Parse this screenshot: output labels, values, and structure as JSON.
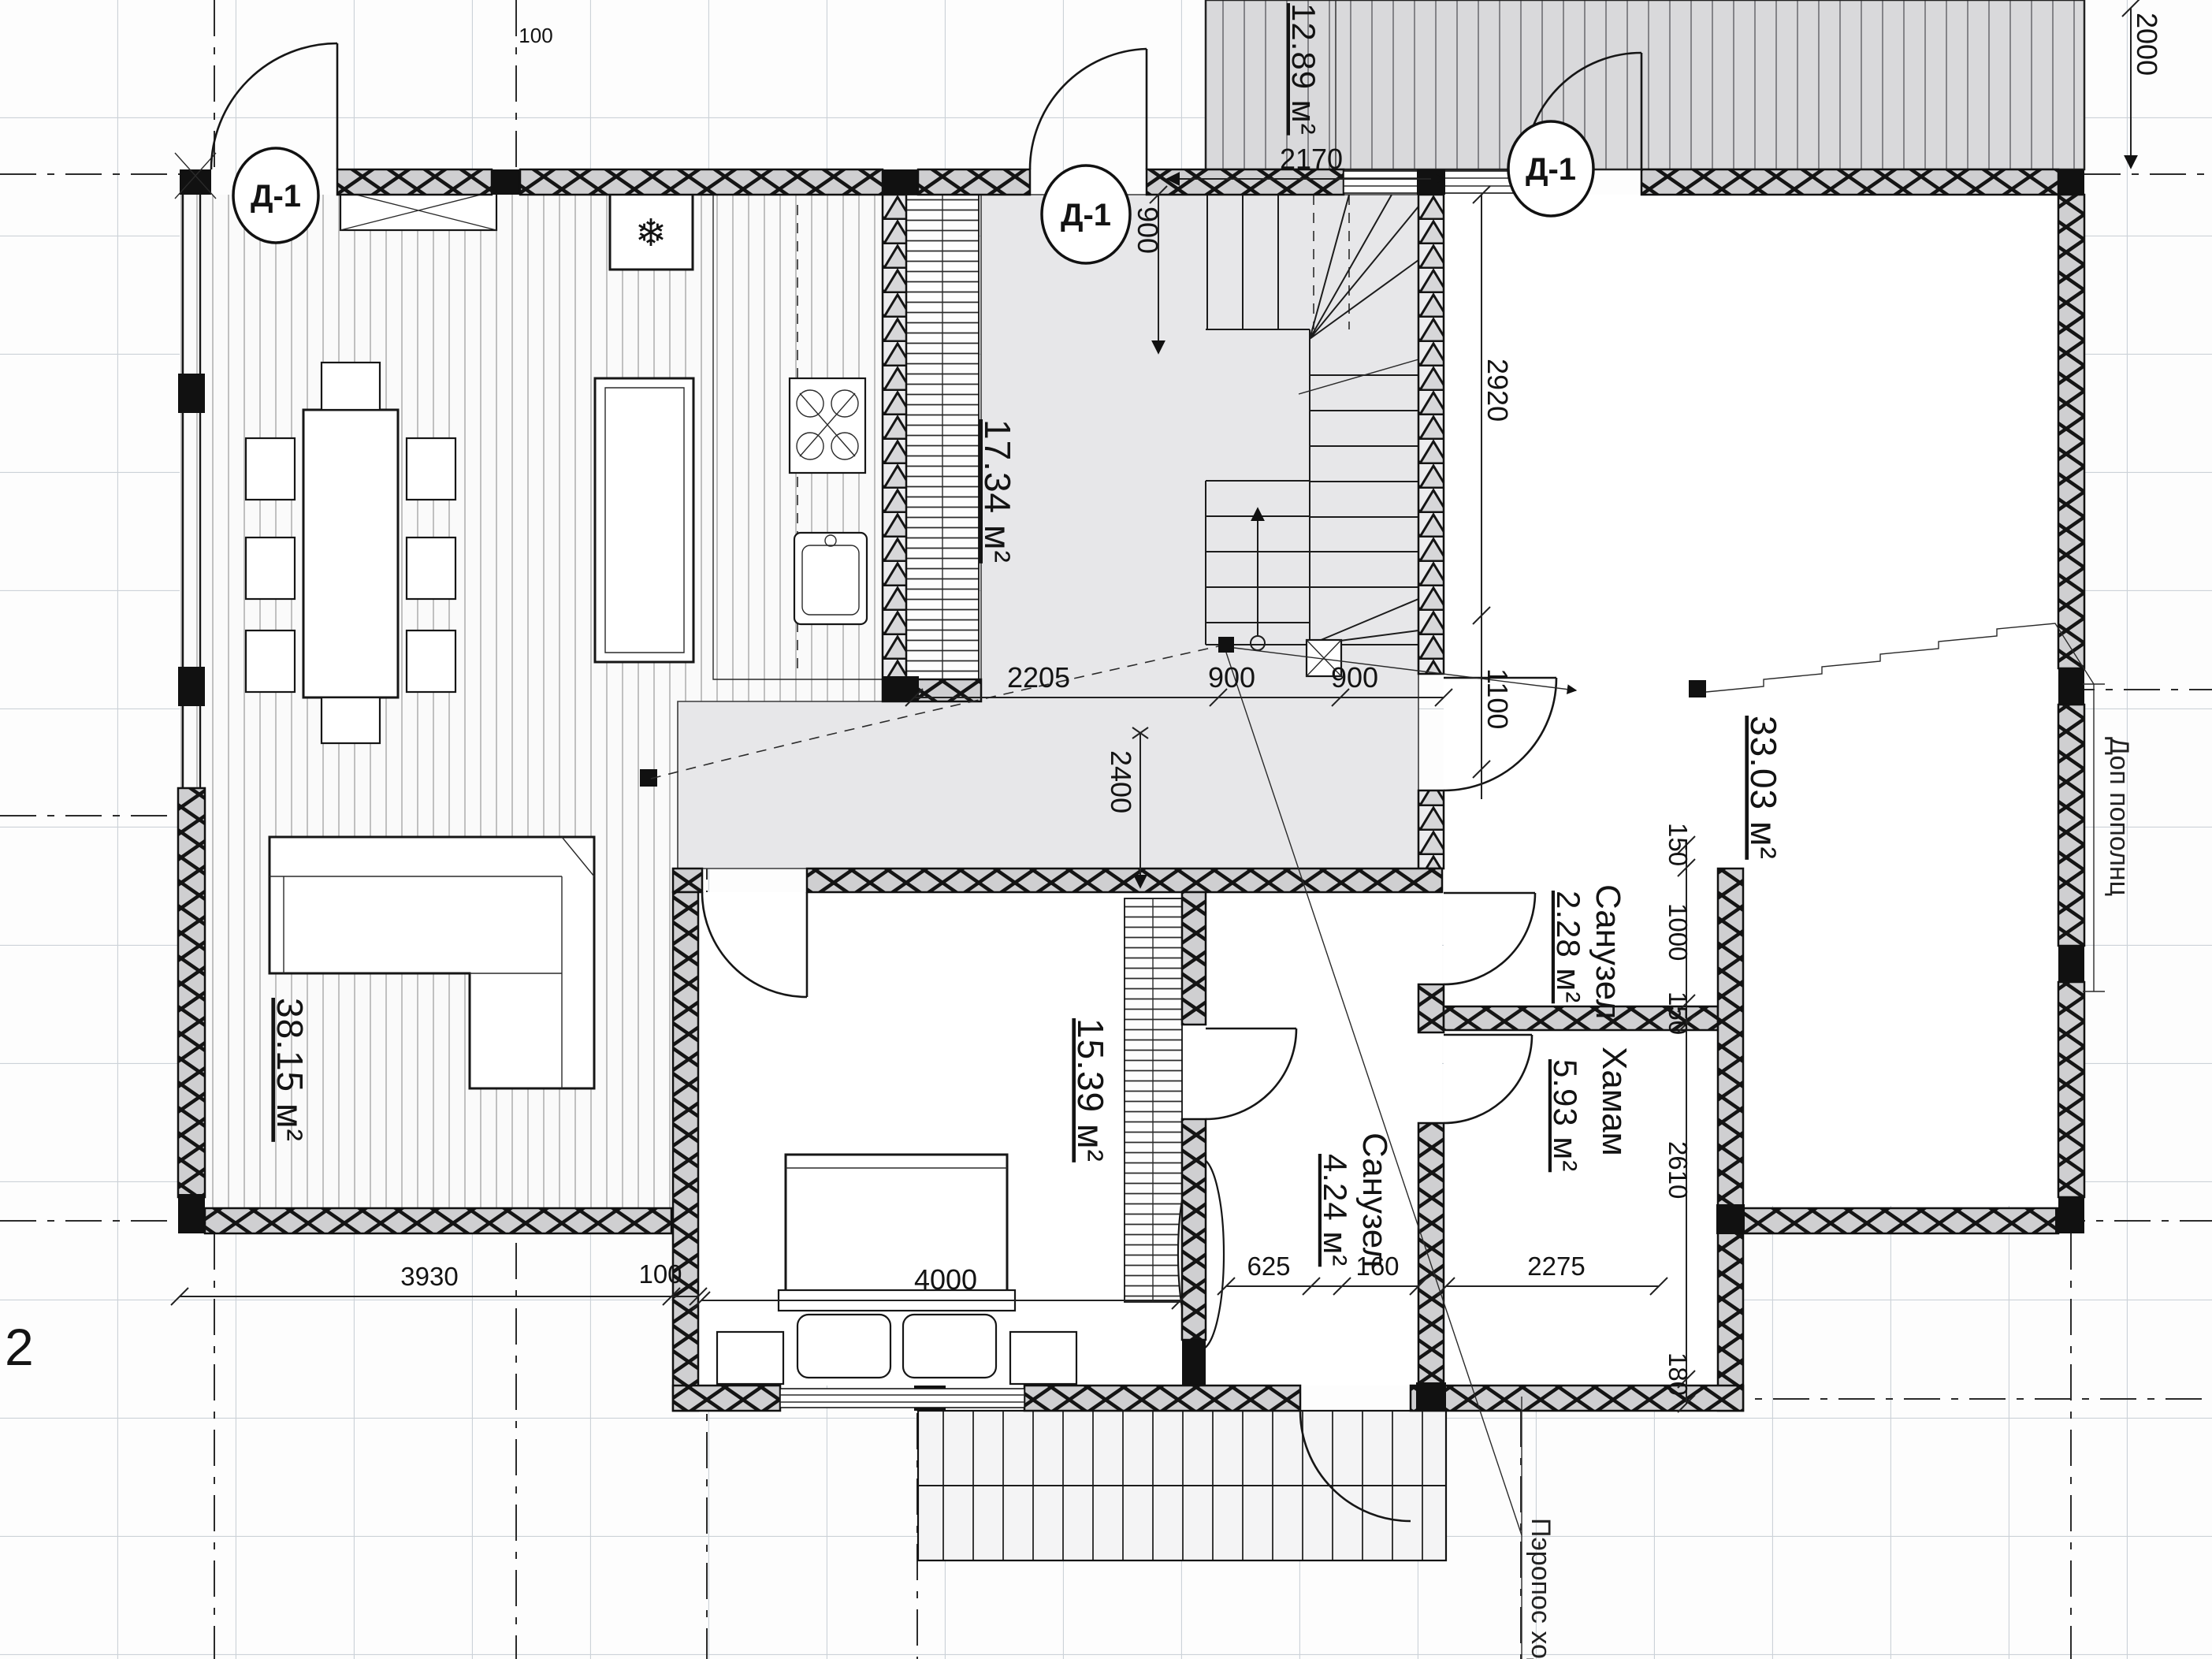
{
  "axis": {
    "label": "2"
  },
  "door_tags": [
    "Д-1",
    "Д-1",
    "Д-1"
  ],
  "icons": {
    "fridge_snowflake": "❄"
  },
  "rooms": {
    "living": {
      "area": "38.15 м²"
    },
    "hall": {
      "area": "17.34 м²"
    },
    "canopy": {
      "area": "12.89 м²"
    },
    "big_room": {
      "area": "33.03 м²"
    },
    "bedroom": {
      "area": "15.39 м²"
    },
    "bathroom": {
      "name": "Санузел",
      "area": "4.24 м²"
    },
    "wc": {
      "name": "Санузел",
      "area": "2.28 м²"
    },
    "hamam": {
      "name": "Хамам",
      "area": "5.93 м²"
    }
  },
  "dims": {
    "canopy_width": "2170",
    "canopy_height": "2000",
    "top_small": "100",
    "stair_width": "900",
    "hall_chain": [
      "2205",
      "900",
      "900"
    ],
    "hall_height": "2400",
    "bigroom_chain": [
      "2920",
      "1100"
    ],
    "wc_chain": [
      "150",
      "1000",
      "150"
    ],
    "hamam_chain": [
      "2610",
      "180"
    ],
    "hamam_width": "2275",
    "bath_chain": [
      "625",
      "160"
    ],
    "bedroom_width": "4000",
    "left_chain": [
      "3930",
      "100"
    ]
  },
  "annotations": {
    "right_note": "Доп пополнц",
    "bottom_note": "Пэропос ход"
  }
}
